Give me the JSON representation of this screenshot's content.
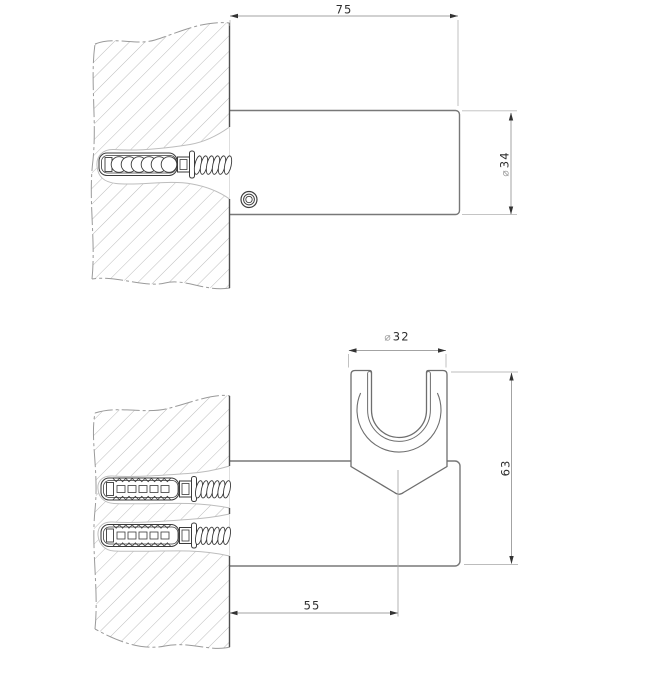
{
  "drawing": {
    "type": "technical-dimension-drawing",
    "views": {
      "side_view": {
        "description": "wall section with single anchor, cylindrical bracket body, set screw underneath",
        "dimensions": [
          "75",
          "⌀34"
        ]
      },
      "front_view": {
        "description": "wall section with two anchors, bracket body with C-shaped handset holder clamp",
        "dimensions": [
          "⌀32",
          "63",
          "55"
        ]
      }
    },
    "dimensions": {
      "body_length": {
        "value": "75"
      },
      "body_diameter": {
        "symbol": "⌀",
        "value": "34"
      },
      "holder_diameter": {
        "symbol": "⌀",
        "value": "32"
      },
      "front_height": {
        "value": "63"
      },
      "front_depth": {
        "value": "55"
      }
    },
    "colors": {
      "background": "#ffffff",
      "outline": "#6e6e6e",
      "dark_line": "#3a3a3a",
      "wall_face": "#4f4f4f",
      "dimension_line": "#a3a3a3",
      "extension_line": "#bcbcbc",
      "hatch": "#b5b5b5",
      "text": "#2e2e2e",
      "diameter_symbol": "#9a9a9a",
      "hole_outline": "#bdbdbd"
    }
  }
}
